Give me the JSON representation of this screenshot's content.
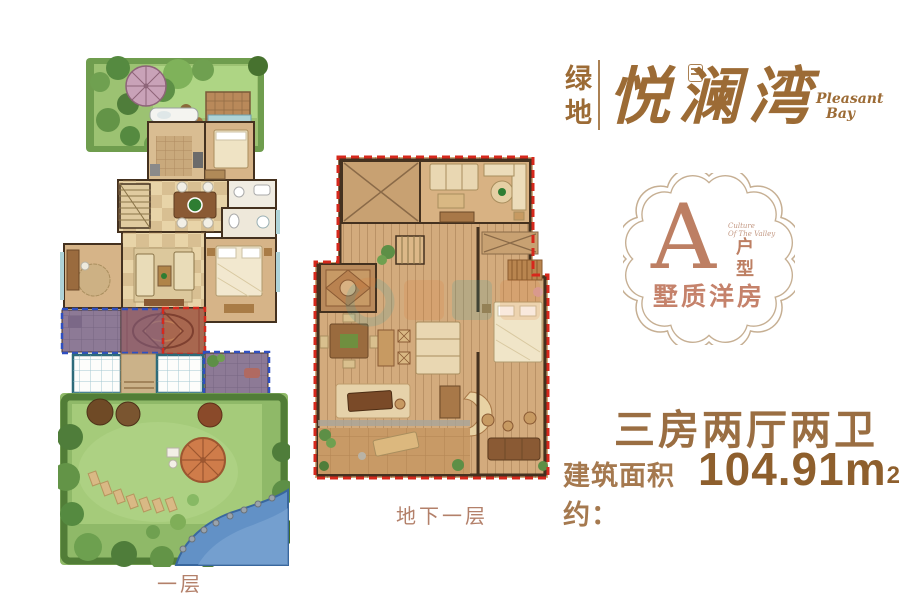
{
  "brand": {
    "cn_left": "绿地",
    "cn_main": "悦澜湾",
    "en_line1": "Pleasant",
    "en_line2": "Bay"
  },
  "badge": {
    "letter": "A",
    "unit_label": "户型",
    "tagline_line1": "Culture",
    "tagline_line2": "Of The Valley",
    "subtitle": "墅质洋房"
  },
  "specs": {
    "layout": "三房两厅两卫",
    "area_label": "建筑面积约：",
    "area_value": "104.91m",
    "area_sup": "2"
  },
  "plans": {
    "first_floor_label": "一层",
    "basement_label": "地下一层"
  },
  "colors": {
    "brand_brown": "#9c6b35",
    "badge_rose": "#bd7f63",
    "badge_border": "#c6af93",
    "spec_brown": "#9a6e42",
    "area_number": "#8e5f2d",
    "dash_red": "#d6281c",
    "dash_blue": "#2f4fc0",
    "label_brown": "#b3806a",
    "garden_green": "#9cc272",
    "wood_tan": "#d3ab7d"
  }
}
